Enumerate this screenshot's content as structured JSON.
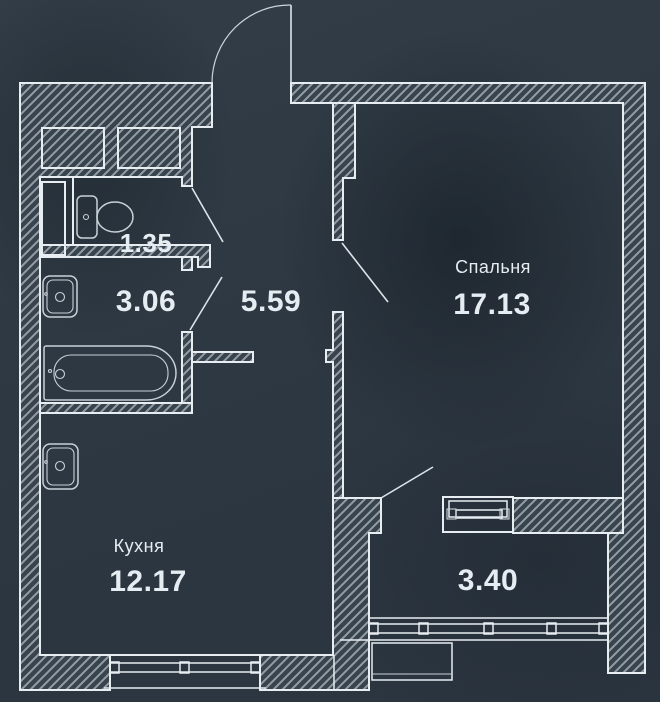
{
  "plan": {
    "title": "apartment-floor-plan",
    "rooms": {
      "wc": {
        "area": "1.35"
      },
      "bathroom": {
        "area": "3.06"
      },
      "hallway": {
        "area": "5.59"
      },
      "bedroom": {
        "name": "Спальня",
        "area": "17.13"
      },
      "kitchen": {
        "name": "Кухня",
        "area": "12.17"
      },
      "balcony": {
        "area": "3.40"
      }
    },
    "fixtures": [
      "toilet-icon",
      "sink-icon",
      "bathtub-icon",
      "kitchen-sink-icon"
    ],
    "doors": [
      "entrance-door",
      "wc-door",
      "bathroom-door",
      "bedroom-door",
      "balcony-door"
    ],
    "windows": [
      "kitchen-window",
      "balcony-glazing",
      "balcony-door-unit"
    ],
    "colors": {
      "background": "#2d3741",
      "wall_fill": "#39434d",
      "hatch_line": "#a2adb6",
      "outline": "#e7edf1",
      "fixture_line": "#c9d1d8",
      "label_text": "#e6edf2"
    }
  }
}
